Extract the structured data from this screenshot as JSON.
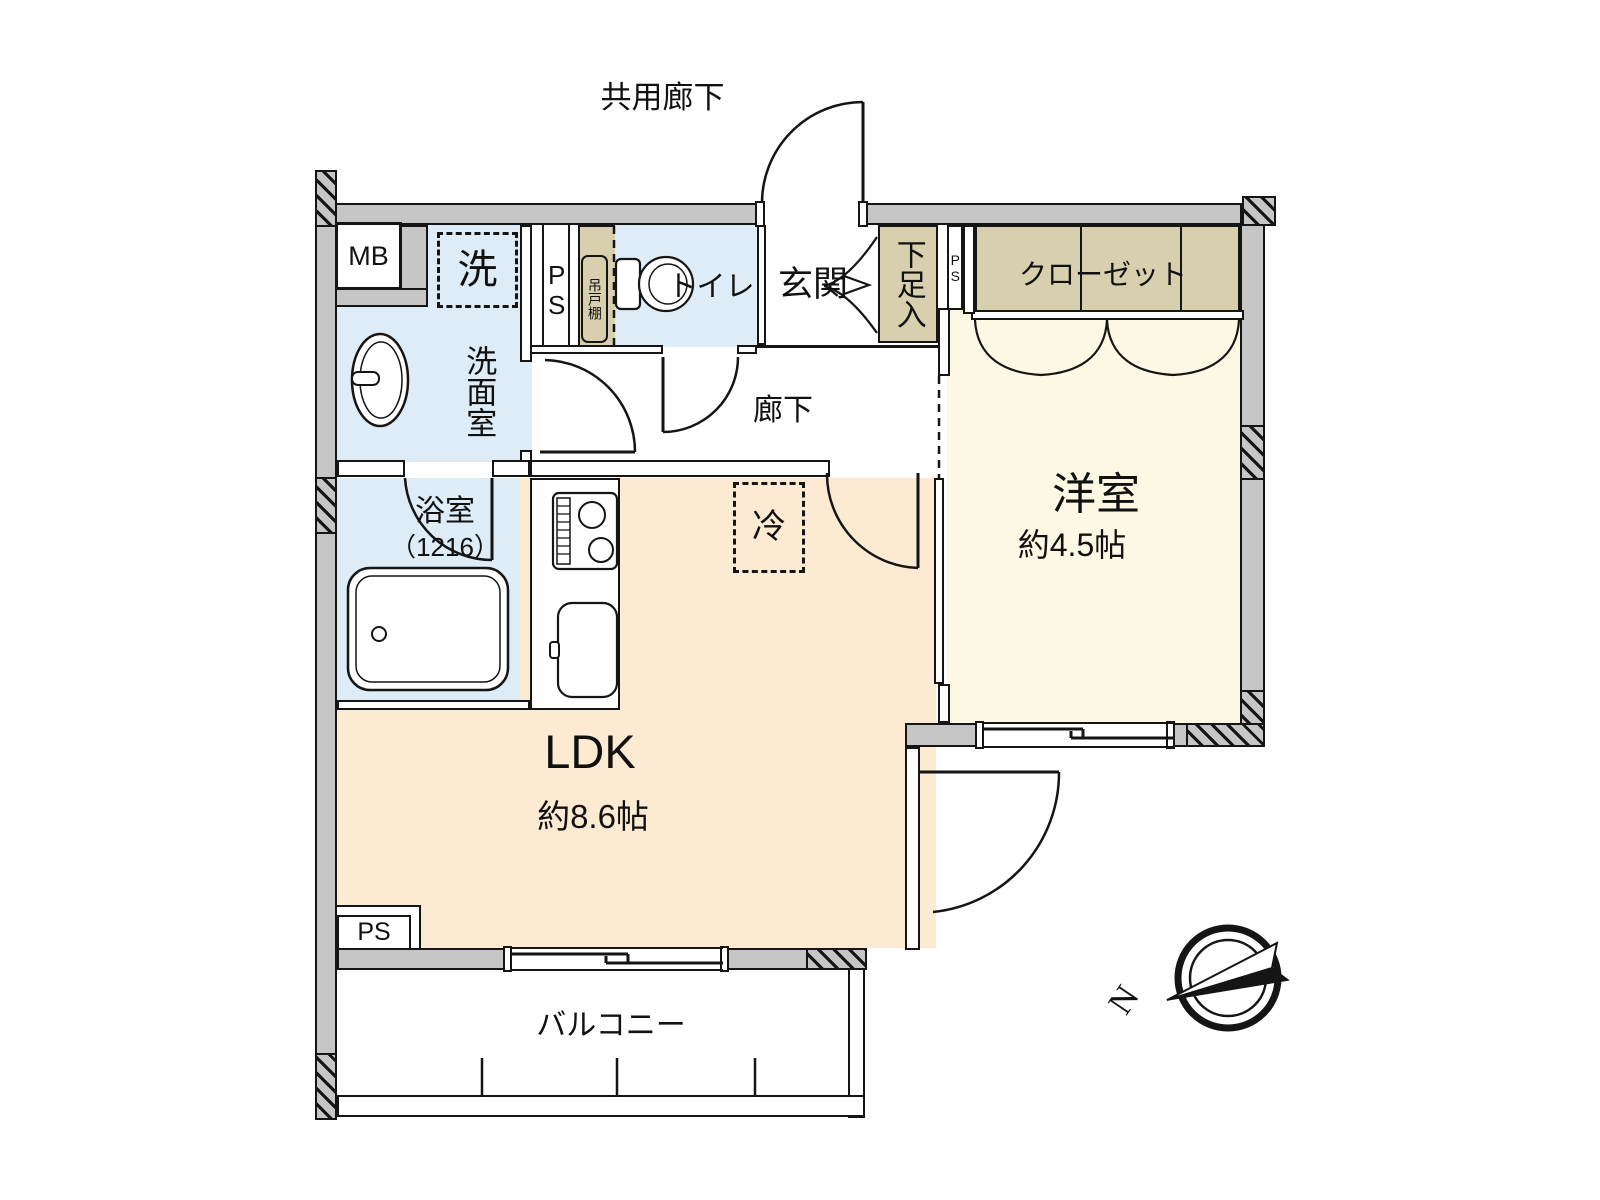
{
  "plan": {
    "type": "apartment-floor-plan",
    "labels": {
      "common_corridor": "共用廊下",
      "meter_box": "MB",
      "washing_machine": "洗",
      "pipe_space_left": "PS",
      "hanging_cupboard": "吊戸棚",
      "toilet": "トイレ",
      "entrance": "玄関",
      "shoe_cabinet": "下足入",
      "pipe_space_small": "PS",
      "closet": "クローゼット",
      "washroom": "洗面室",
      "hallway": "廊下",
      "bathroom_name": "浴室",
      "bathroom_size": "（1216）",
      "refrigerator": "冷",
      "western_room_name": "洋室",
      "western_room_size": "約4.5帖",
      "ldk_name": "LDK",
      "ldk_size": "約8.6帖",
      "pipe_space_bottom": "PS",
      "balcony": "バルコニー",
      "compass_north": "N"
    },
    "colors": {
      "wall_gray": "#c6c6c6",
      "water_blue": "#ddecf7",
      "storage_tan": "#d8cfae",
      "room_cream": "#fcf8e3",
      "ldk_peach": "#fdead3",
      "line_black": "#151515"
    },
    "icons": [
      "toilet-icon",
      "washbasin-icon",
      "bathtub-icon",
      "stove-icon",
      "kitchen-sink-icon",
      "door-swing-arc",
      "sliding-door",
      "double-door-arc",
      "folding-closet-doors",
      "sliding-window",
      "balcony-divider",
      "compass-north-icon"
    ]
  }
}
